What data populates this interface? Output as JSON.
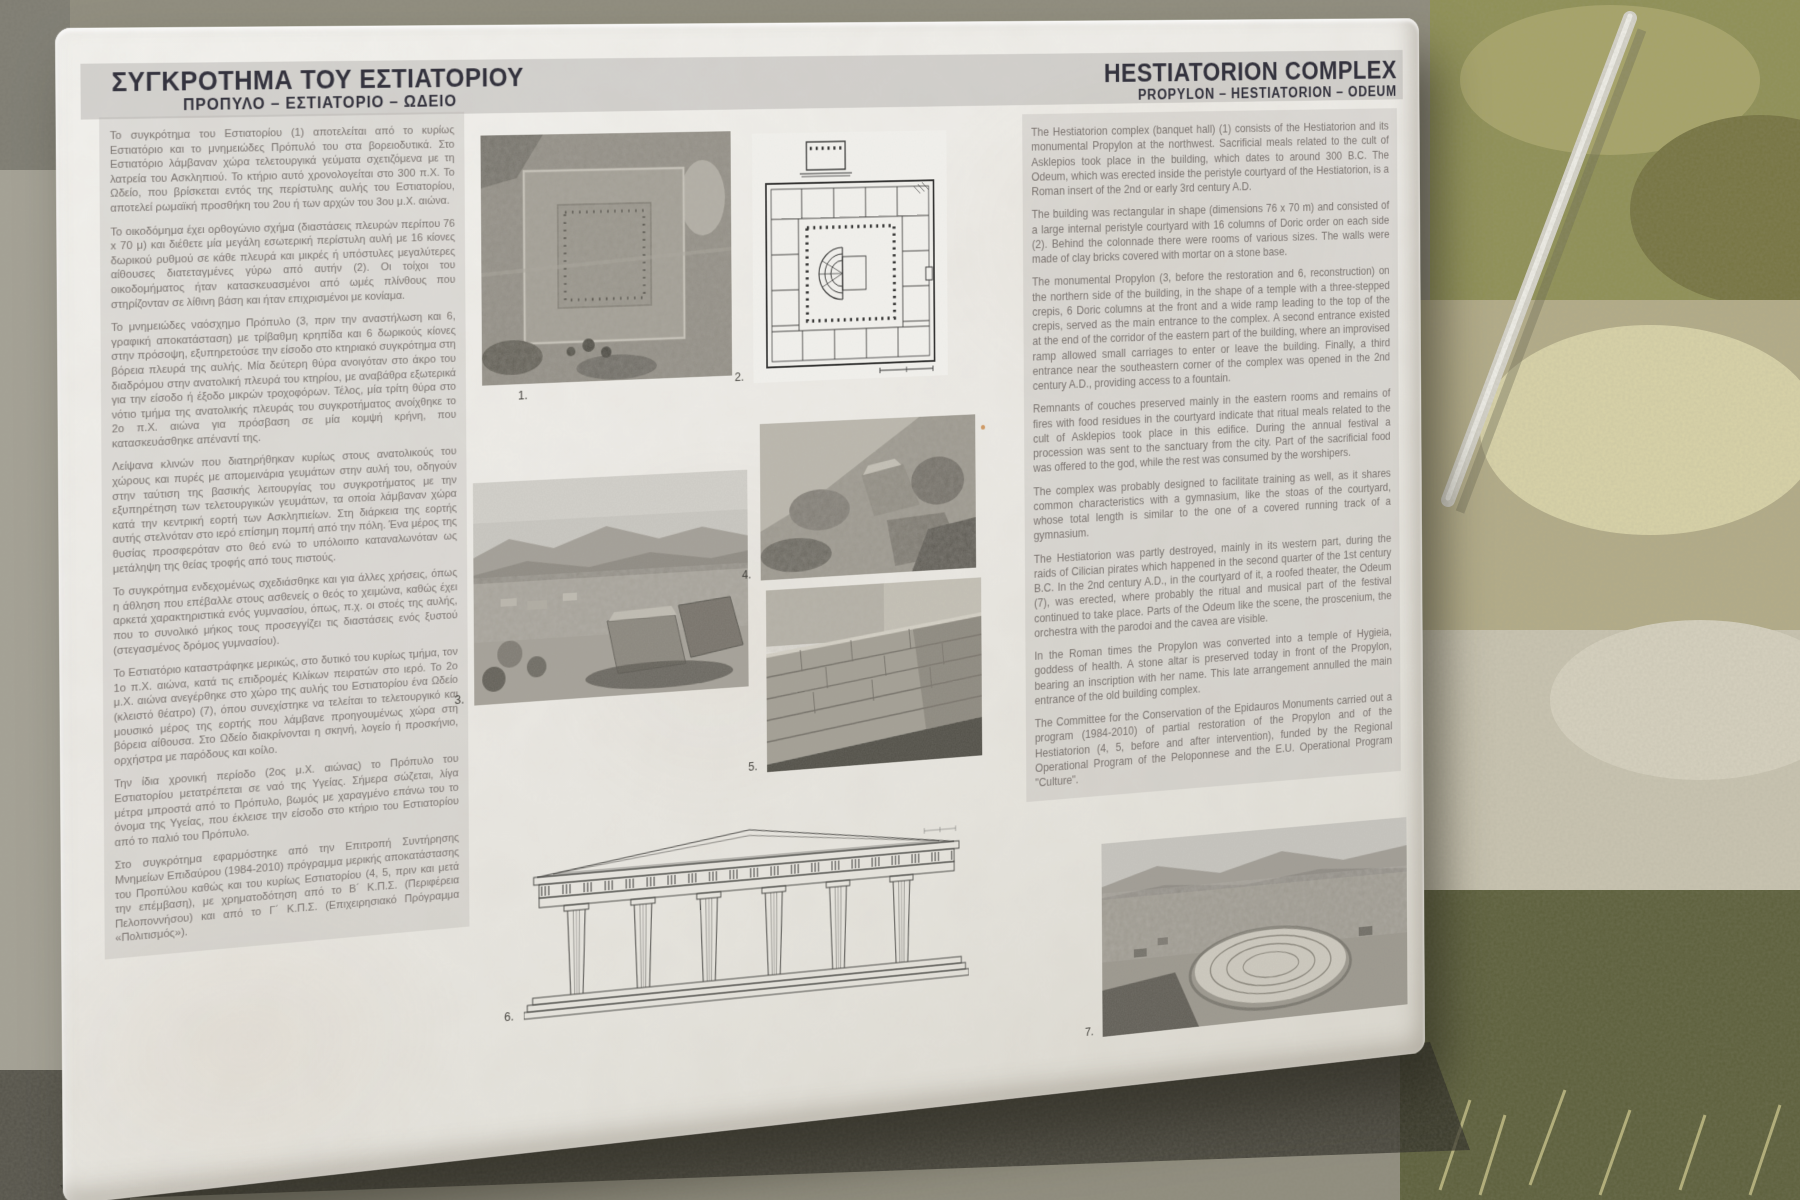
{
  "panel": {
    "greek": {
      "title": "ΣΥΓΚΡΟΤΗΜΑ ΤΟΥ ΕΣΤΙΑΤΟΡΙΟΥ",
      "subtitle": "ΠΡΟΠΥΛΟ – ΕΣΤΙΑΤΟΡΙΟ – ΩΔΕΙΟ",
      "paragraphs": [
        "Το συγκρότημα του Εστιατορίου (1) αποτελείται από το κυρίως Εστιατόριο και το μνημειώδες Πρόπυλό του στα βορειοδυτικά. Στο Εστιατόριο λάμβαναν χώρα τελετουργικά γεύματα σχετιζόμενα με τη λατρεία του Ασκληπιού. Το κτήριο αυτό χρονολογείται στο 300 π.Χ. Το Ωδείο, που βρίσκεται εντός της περίστυλης αυλής του Εστιατορίου, αποτελεί ρωμαϊκή προσθήκη του 2ου ή των αρχών του 3ου μ.Χ. αιώνα.",
        "Το οικοδόμημα έχει ορθογώνιο σχήμα (διαστάσεις πλευρών περίπου 76 x 70 μ) και διέθετε μία μεγάλη εσωτερική περίστυλη αυλή με 16 κίονες δωρικού ρυθμού σε κάθε πλευρά και μικρές ή υπόστυλες μεγαλύτερες αίθουσες διατεταγμένες γύρω από αυτήν (2). Οι τοίχοι του οικοδομήματος ήταν κατασκευασμένοι από ωμές πλίνθους που στηρίζονταν σε λίθινη βάση και ήταν επιχρισμένοι με κονίαμα.",
        "Το μνημειώδες ναόσχημο Πρόπυλο (3, πριν την αναστήλωση και 6, γραφική αποκατάσταση) με τρίβαθμη κρηπίδα και 6 δωρικούς κίονες στην πρόσοψη, εξυπηρετούσε την είσοδο στο κτηριακό συγκρότημα στη βόρεια πλευρά της αυλής. Μία δεύτερη θύρα ανοιγόταν στο άκρο του διαδρόμου στην ανατολική πλευρά του κτηρίου, με αναβάθρα εξωτερικά για την είσοδο ή έξοδο μικρών τροχοφόρων. Τέλος, μία τρίτη θύρα στο νότιο τμήμα της ανατολικής πλευράς του συγκροτήματος ανοίχθηκε το 2ο π.Χ. αιώνα για πρόσβαση σε μία κομψή κρήνη, που κατασκευάσθηκε απέναντί της.",
        "Λείψανα κλινών που διατηρήθηκαν κυρίως στους ανατολικούς του χώρους και πυρές με απομεινάρια γευμάτων στην αυλή του, οδηγούν στην ταύτιση της βασικής λειτουργίας του συγκροτήματος με την εξυπηρέτηση των τελετουργικών γευμάτων, τα οποία λάμβαναν χώρα κατά την κεντρική εορτή των Ασκληπιείων. Στη διάρκεια της εορτής αυτής στελνόταν στο ιερό επίσημη πομπή από την πόλη. Ένα μέρος της θυσίας προσφερόταν στο θεό ενώ το υπόλοιπο καταναλωνόταν ως μετάληψη της θείας τροφής από τους πιστούς.",
        "Το συγκρότημα ενδεχομένως σχεδιάσθηκε και για άλλες χρήσεις, όπως η άθληση που επέβαλλε στους ασθενείς ο θεός το χειμώνα, καθώς έχει αρκετά χαρακτηριστικά ενός γυμνασίου, όπως, π.χ. οι στοές της αυλής, που το συνολικό μήκος τους προσεγγίζει τις διαστάσεις ενός ξυστού (στεγασμένος δρόμος γυμνασίου).",
        "Το Εστιατόριο καταστράφηκε μερικώς, στο δυτικό του κυρίως τμήμα, τον 1ο π.Χ. αιώνα, κατά τις επιδρομές Κιλίκων πειρατών στο ιερό. Το 2ο μ.Χ. αιώνα ανεγέρθηκε στο χώρο της αυλής του Εστιατορίου ένα Ωδείο (κλειστό θέατρο) (7), όπου συνεχίστηκε να τελείται το τελετουργικό και μουσικό μέρος της εορτής που λάμβανε προηγουμένως χώρα στη βόρεια αίθουσα. Στο Ωδείο διακρίνονται η σκηνή, λογείο ή προσκήνιο, ορχήστρα με παρόδους και κοίλο.",
        "Την ίδια χρονική περίοδο (2ος μ.Χ. αιώνας) το Πρόπυλο του Εστιατορίου μετατρέπεται σε ναό της Υγείας. Σήμερα σώζεται, λίγα μέτρα μπροστά από το Πρόπυλο, βωμός με χαραγμένο επάνω του το όνομα της Υγείας, που έκλεισε την είσοδο στο κτήριο του Εστιατορίου από το παλιό του Πρόπυλο.",
        "Στο συγκρότημα εφαρμόστηκε από την Επιτροπή Συντήρησης Μνημείων Επιδαύρου (1984-2010) πρόγραμμα μερικής αποκατάστασης του Προπύλου καθώς και του κυρίως Εστιατορίου (4, 5, πριν και μετά την επέμβαση), με χρηματοδότηση από το Β´ Κ.Π.Σ. (Περιφέρεια Πελοποννήσου) και από το Γ´ Κ.Π.Σ. (Επιχειρησιακό Πρόγραμμα «Πολιτισμός»)."
      ]
    },
    "english": {
      "title": "HESTIATORION COMPLEX",
      "subtitle": "PROPYLON – HESTIATORION – ODEUM",
      "paragraphs": [
        "The Hestiatorion complex (banquet hall) (1) consists of the Hestiatorion and its monumental Propylon at the northwest. Sacrificial meals related to the cult of Asklepios took place in the building, which dates to around 300 B.C. The Odeum, which was erected inside the peristyle courtyard of the Hestiatorion, is a Roman insert of the 2nd or early 3rd century A.D.",
        "The building was rectangular in shape (dimensions 76 x 70 m) and consisted of a large internal peristyle courtyard with 16 columns of Doric order on each side (2). Behind the colonnade there were rooms of various sizes. The walls were made of clay bricks covered with mortar on a stone base.",
        "The monumental Propylon (3, before the restoration and 6, reconstruction) on the northern side of the building, in the shape of a temple with a three-stepped crepis, 6 Doric columns at the front and a wide ramp leading to the top of the crepis, served as the main entrance to the complex. A second entrance existed at the end of the corridor of the eastern part of the building, where an improvised ramp allowed small carriages to enter or leave the building.  Finally, a third entrance near the southeastern corner of the complex was opened in the 2nd century A.D., providing access to a fountain.",
        "Remnants of couches preserved mainly in the eastern rooms and remains of fires with food residues in the courtyard indicate that ritual meals related to the cult of Asklepios took place in this edifice. During the annual festival a procession was sent to the sanctuary from the city. Part of the sacrificial food was offered to the god, while the rest was consumed by the worshipers.",
        "The complex was probably designed to facilitate training as well, as it shares common characteristics with a gymnasium, like the stoas of the courtyard, whose total length is similar to the one of a covered running track of a gymnasium.",
        "The Hestiatorion was partly destroyed, mainly in its western part, during the raids of Cilician pirates which happened in the second quarter of the 1st century B.C. In the 2nd century A.D., in the courtyard of it, a roofed theater, the Odeum (7), was erected, where probably the ritual and musical part of the festival continued to take place. Parts of the Odeum like the scene, the proscenium, the orchestra with the parodoi and the cavea are visible.",
        "In the Roman times the Propylon was converted into a temple of Hygieia, goddess of health. A stone altar is preserved today in front of the Propylon, bearing an inscription with her name. This late arrangement annulled the main entrance of the old building complex.",
        "The Committee for the Conservation of the Epidauros Monuments carried out a program (1984-2010) of partial restoration of the Propylon and of the Hestiatorion (4, 5, before and after intervention), funded by the Regional Operational Program of the Peloponnese and the E.U. Operational Program \"Culture\"."
      ]
    },
    "figures": [
      {
        "caption": "1.",
        "name": "aerial-photo-of-hestiatorion"
      },
      {
        "caption": "2.",
        "name": "ground-plan-drawing"
      },
      {
        "caption": "3.",
        "name": "ruins-photo-propylon-before-restoration"
      },
      {
        "caption": "4.",
        "name": "ruins-photo-before-intervention"
      },
      {
        "caption": "5.",
        "name": "restored-wall-photo-after-intervention"
      },
      {
        "caption": "6.",
        "name": "propylon-elevation-drawing"
      },
      {
        "caption": "7.",
        "name": "odeum-photo"
      }
    ],
    "colors": {
      "panel": "#ebe9e4",
      "header_band": "#c9c7c3",
      "title_text": "#34333e",
      "body_text": "#7b7470"
    }
  }
}
